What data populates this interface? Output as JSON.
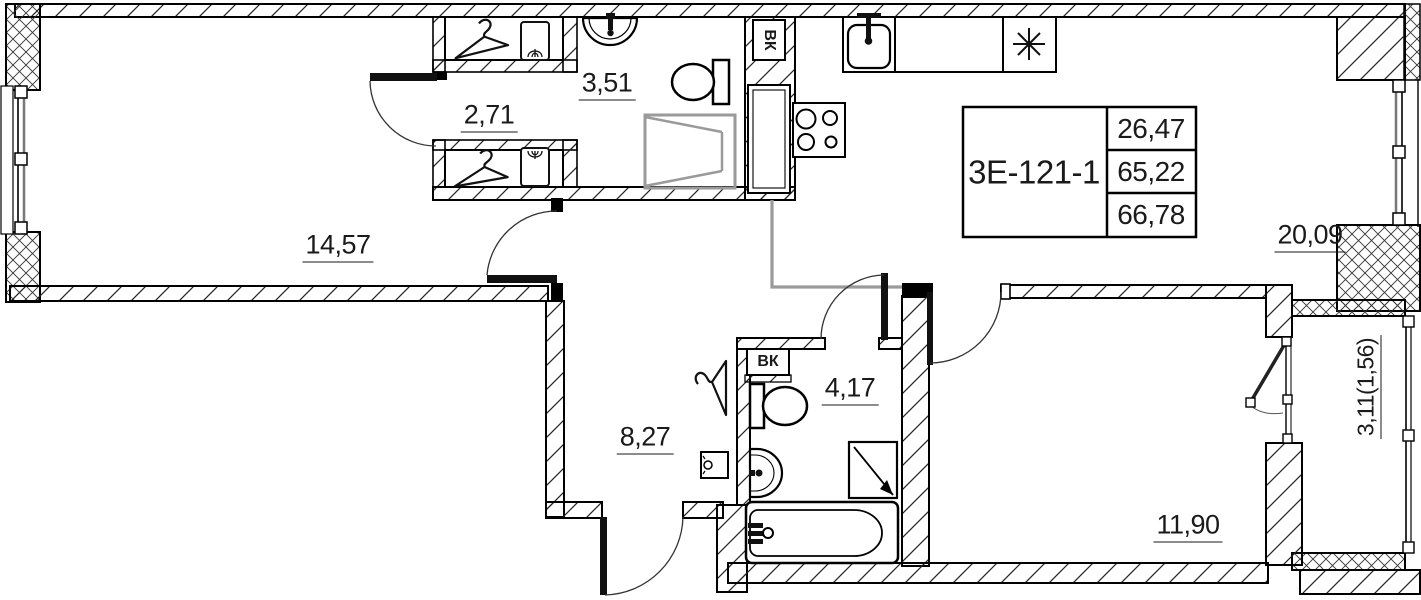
{
  "plan": {
    "apartment": {
      "code": "3Е-121-1",
      "values": [
        "26,47",
        "65,22",
        "66,78"
      ]
    },
    "rooms": [
      {
        "id": "hall",
        "area": "14,57"
      },
      {
        "id": "wardrobe",
        "area": "2,71"
      },
      {
        "id": "bathroom-top",
        "area": "3,51"
      },
      {
        "id": "kitchen-living",
        "area": "20,09"
      },
      {
        "id": "corridor",
        "area": "8,27"
      },
      {
        "id": "bathroom",
        "area": "4,17"
      },
      {
        "id": "bedroom",
        "area": "11,90"
      },
      {
        "id": "balcony",
        "area": "3,11(1,56)"
      }
    ],
    "shafts": [
      {
        "label": "ВК"
      },
      {
        "label": "ВК"
      }
    ]
  }
}
